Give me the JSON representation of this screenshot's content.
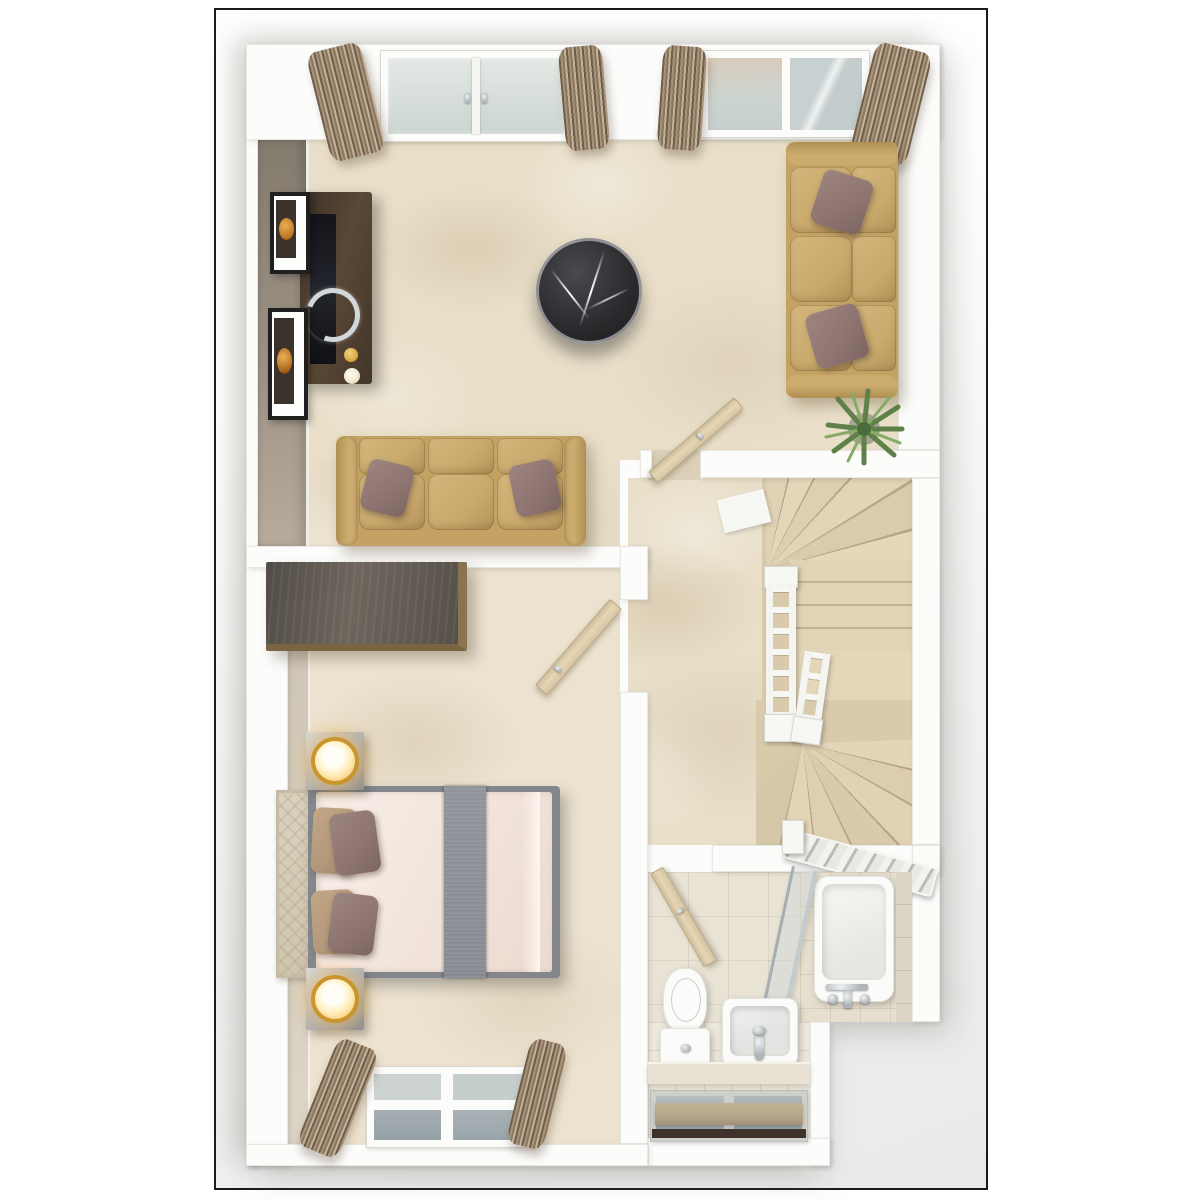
{
  "image": {
    "kind": "3d-floorplan-render",
    "view": "top-down",
    "storeys_shown": 1,
    "visible_text": "none"
  },
  "scene": {
    "rooms": [
      {
        "id": "living-room",
        "position": "top",
        "furniture": [
          "tv-media-console",
          "flat-tv-with-ring-stand",
          "gold-candles",
          "picture-frame-upper",
          "picture-frame-lower",
          "round-black-marble-coffee-table",
          "three-seat-sofa-left",
          "three-seat-sofa-right",
          "mauve-throw-pillows",
          "potted-palm-plant",
          "french-window",
          "double-window",
          "four-curtain-panels",
          "open-door-to-hall"
        ]
      },
      {
        "id": "bedroom",
        "position": "bottom-left",
        "furniture": [
          "double-bed",
          "grey-bed-runner",
          "upholstered-headboard",
          "tan-pillows",
          "mauve-pillows",
          "wardrobe",
          "nightstand-with-lamp-top",
          "nightstand-with-lamp-bottom",
          "window-with-curtains",
          "open-door-to-hall"
        ]
      },
      {
        "id": "hallway-stairs",
        "position": "middle-right",
        "furniture": [
          "winder-staircase",
          "quarter-landing",
          "spindle-balustrade-long",
          "spindle-balustrade-short",
          "bottom-handrail"
        ]
      },
      {
        "id": "bathroom",
        "position": "bottom-right",
        "furniture": [
          "toilet",
          "washbasin-with-faucet",
          "bathtub-with-faucet",
          "glass-shower-screen",
          "tiled-ledge",
          "window-with-roller-blind",
          "open-door"
        ]
      }
    ]
  },
  "palette": {
    "page_bg": "#ffffff",
    "frame_border": "#1b1b1b",
    "frame_bg": "#eaeaea",
    "wall": "#fcfcfb",
    "wall_edge": "#e7e7e3",
    "wall_face_dark": "#8e8478",
    "wall_face_light": "#d2c9ba",
    "carpet": "#e9dfc9",
    "bedroom_carpet": "#ece2cf",
    "sofa": "#c4a263",
    "sofa_cushion": "#c9a96c",
    "pillow_mauve": "#8d7470",
    "pillow_tan": "#b3987a",
    "wood_dark": "#4d3e2f",
    "door_wood": "#e6d6b4",
    "curtain_dark": "#6f5e4b",
    "curtain_light": "#c3b29a",
    "glass": "#d9e1de",
    "glass_dark": "#9ba5a9",
    "marble": "#2b2a2d",
    "stair": "#dccead",
    "stair_line": "#b7a685",
    "tile_wall": "#e9e3d5",
    "tile_floor": "#ede8dc",
    "white_fixture": "#fbfbf9",
    "chrome": "#aeb4b8",
    "lamp_ring": "#c9952c",
    "lamp_glow": "#f6c868",
    "plant_green": "#5d8148",
    "duvet": "#f6eae3",
    "runner": "#8d9197",
    "bed_frame": "#84888d",
    "blind_tan": "#b4a489",
    "blind_rail": "#3e322a"
  }
}
